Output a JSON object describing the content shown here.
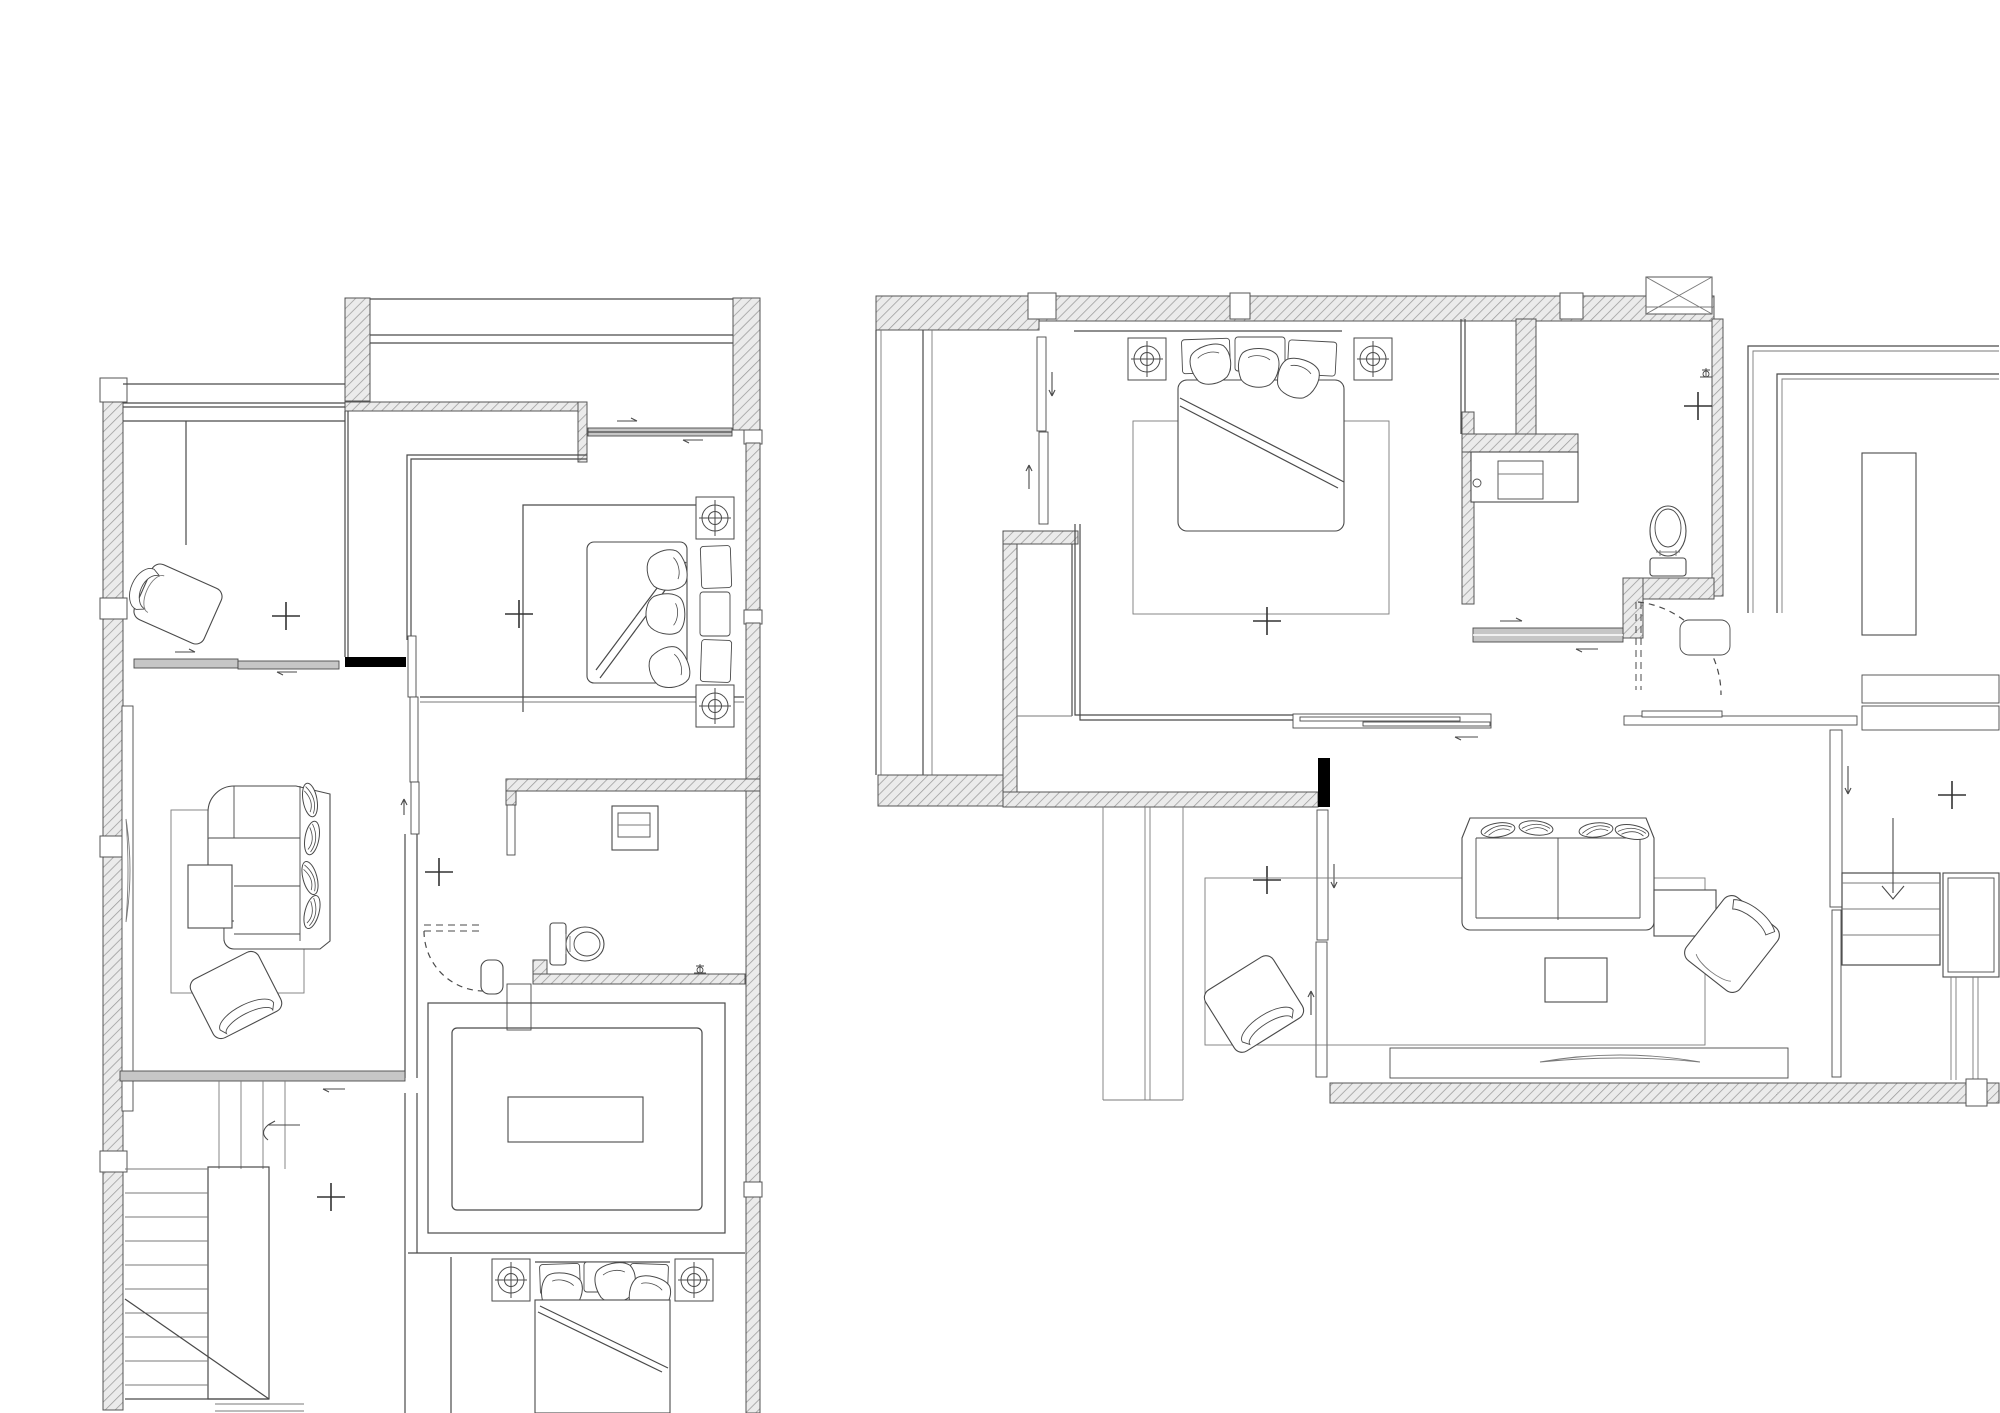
{
  "document": {
    "kind": "architectural-floor-plan-drawing",
    "visible_text": [],
    "background_color": "#ffffff",
    "line_color": "#4a4a4a",
    "wall_hatch_color": "#9a9a9a",
    "wall_fill_color": "#ebebeb",
    "solid_wall_color": "#000000",
    "glass_band_color": "#c6c6c6"
  },
  "plans": [
    {
      "id": "left-plan",
      "position": "left",
      "rooms": [
        "balcony",
        "study",
        "master-bedroom",
        "living-area",
        "hallway",
        "toilet-room",
        "tatami-room",
        "stair-hall",
        "lower-bedroom"
      ],
      "furniture": [
        "chaise-chair",
        "double-bed-with-pillows",
        "l-shaped-sofa",
        "coffee-table",
        "armchair",
        "tv-console",
        "toilet",
        "wash-basin",
        "tatami-platform",
        "low-table",
        "stairs-up",
        "lower-double-bed"
      ],
      "symbol_counts": {
        "plus_marks": 4,
        "ceiling_fixture_symbols": 4,
        "sliding_door_tracks": 3,
        "door_swings": 2
      }
    },
    {
      "id": "right-plan",
      "position": "right",
      "rooms": [
        "stair-void",
        "master-bedroom",
        "walk-in-closet",
        "bathroom",
        "big-room",
        "hall",
        "living-room",
        "stairs-down-area"
      ],
      "furniture": [
        "double-bed-with-pillows",
        "nightstand-symbols",
        "area-rug",
        "vanity-with-sink",
        "toilet",
        "outdoor-ac-unit",
        "desk-counter",
        "straight-sofa",
        "ottoman",
        "armchair",
        "armchair-2",
        "tv-console",
        "stairs-down",
        "side-desk"
      ],
      "symbol_counts": {
        "plus_marks": 4,
        "ceiling_fixture_symbols": 2,
        "sliding_door_tracks": 4,
        "door_swings": 1
      }
    }
  ]
}
